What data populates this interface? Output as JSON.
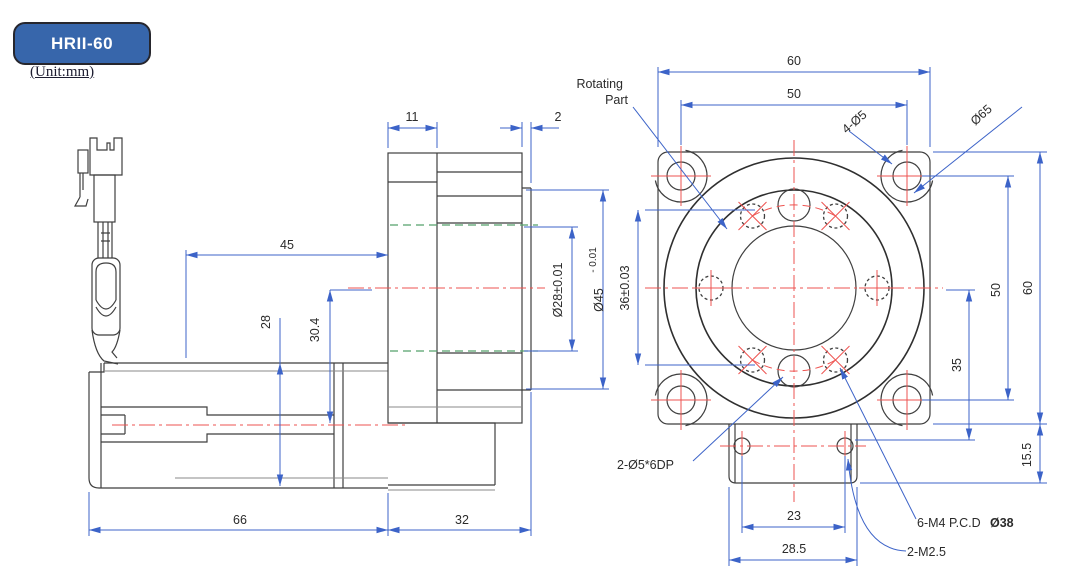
{
  "header": {
    "model": "HRII-60",
    "unit": "(Unit:mm)"
  },
  "colors": {
    "badge_fill": "#3766ab",
    "badge_border": "#26262d",
    "dimension_blue": "#3c63c8",
    "centerline_red": "#ee5350",
    "hidden_green": "#53a06b",
    "outline_dark": "#3f3f3f"
  },
  "side_view": {
    "dims": {
      "top_width": "11",
      "lip_thickness": "2",
      "mid_length": "45",
      "body_height": "28",
      "axis_offset": "30.4",
      "bore_dia": "Ø28±0.01",
      "boss_dia": "Ø45",
      "boss_tol": "- 0.01",
      "motor_length": "66",
      "head_length": "32"
    }
  },
  "front_view": {
    "labels": {
      "rotating_1": "Rotating",
      "rotating_2": "Part",
      "corner_holes": "4-Ø5",
      "flange_dia": "Ø65",
      "pin_holes": "2-Ø5*6DP",
      "tap_prefix": "6-M4 P.C.D",
      "tap_pcd": "Ø38",
      "bottom_taps": "2-M2.5"
    },
    "dims": {
      "top_outer": "60",
      "top_inner": "50",
      "left_pilot": "36±0.03",
      "right_inner": "50",
      "right_outer": "60",
      "right_mid": "35",
      "tab_height": "15.5",
      "tab_holes": "23",
      "tab_width": "28.5"
    }
  }
}
